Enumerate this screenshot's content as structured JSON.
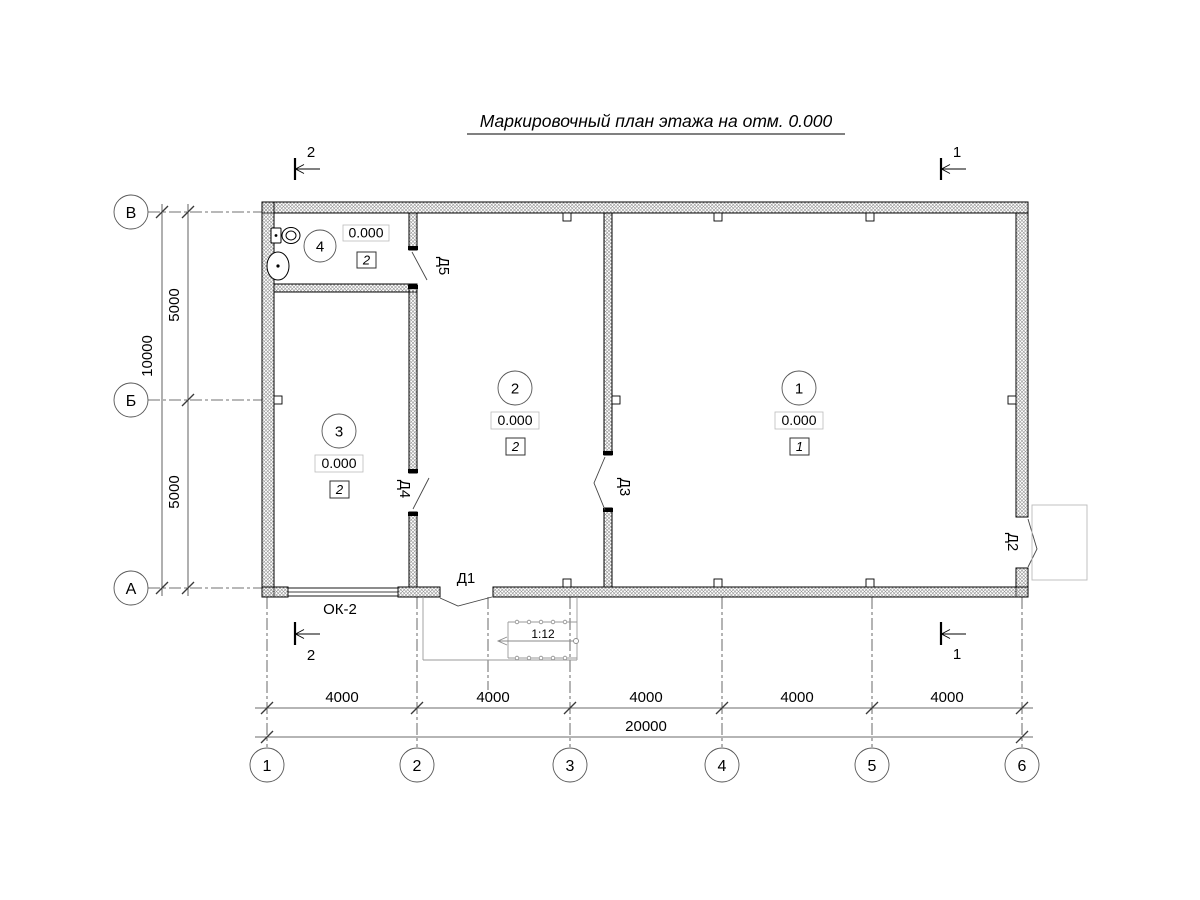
{
  "title": "Маркировочный план этажа на отм. 0.000",
  "axes": {
    "cols": [
      "1",
      "2",
      "3",
      "4",
      "5",
      "6"
    ],
    "rows": [
      "В",
      "Б",
      "А"
    ]
  },
  "dims": {
    "bottom_segments": [
      "4000",
      "4000",
      "4000",
      "4000",
      "4000"
    ],
    "bottom_total": "20000",
    "left_segments": [
      "5000",
      "5000"
    ],
    "left_total": "10000"
  },
  "sections": {
    "one": "1",
    "two": "2"
  },
  "rooms": [
    {
      "number": "1",
      "elevation": "0.000",
      "floor_type": "1"
    },
    {
      "number": "2",
      "elevation": "0.000",
      "floor_type": "2"
    },
    {
      "number": "3",
      "elevation": "0.000",
      "floor_type": "2"
    },
    {
      "number": "4",
      "elevation": "0.000",
      "floor_type": "2"
    }
  ],
  "doors": {
    "d1": "Д1",
    "d2": "Д2",
    "d3": "Д3",
    "d4": "Д4",
    "d5": "Д5"
  },
  "window_label": "ОК-2",
  "ramp": {
    "slope": "1:12"
  },
  "colors": {
    "line": "#000000",
    "hatch": "#8f8f8f",
    "thin": "#3a3a3a",
    "light": "#bbbbbb"
  }
}
